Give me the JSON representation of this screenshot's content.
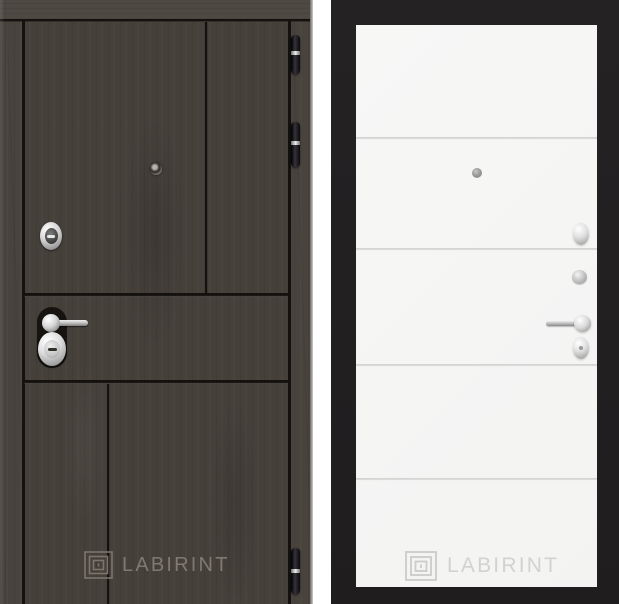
{
  "image": {
    "description": "Two-view product photo of LABIRINT entrance door: dark wood exterior side and white interior side",
    "background": "#ffffff"
  },
  "left_door": {
    "brand": "LABIRINT",
    "wood_color": "#45403a",
    "groove_color": "#14110e",
    "logo_color": "#8a847b",
    "hardware": {
      "peephole": "peephole",
      "upper_lock": "cylinder-keyhole-escutcheon",
      "handle": "chrome-lever-handle",
      "lower_lock": "oval-keyhole-escutcheon",
      "hinge_count": 3
    }
  },
  "right_door": {
    "brand": "LABIRINT",
    "frame_color": "#232122",
    "panel_color": "#f6f6f5",
    "groove_count": 4,
    "logo_color": "#d2d2d2",
    "hardware": {
      "peephole": "peephole",
      "night_latch": "cylinder-cover",
      "cylinder": "lock-cylinder",
      "handle": "chrome-lever-handle",
      "lower_lock": "oval-turn-knob"
    }
  }
}
